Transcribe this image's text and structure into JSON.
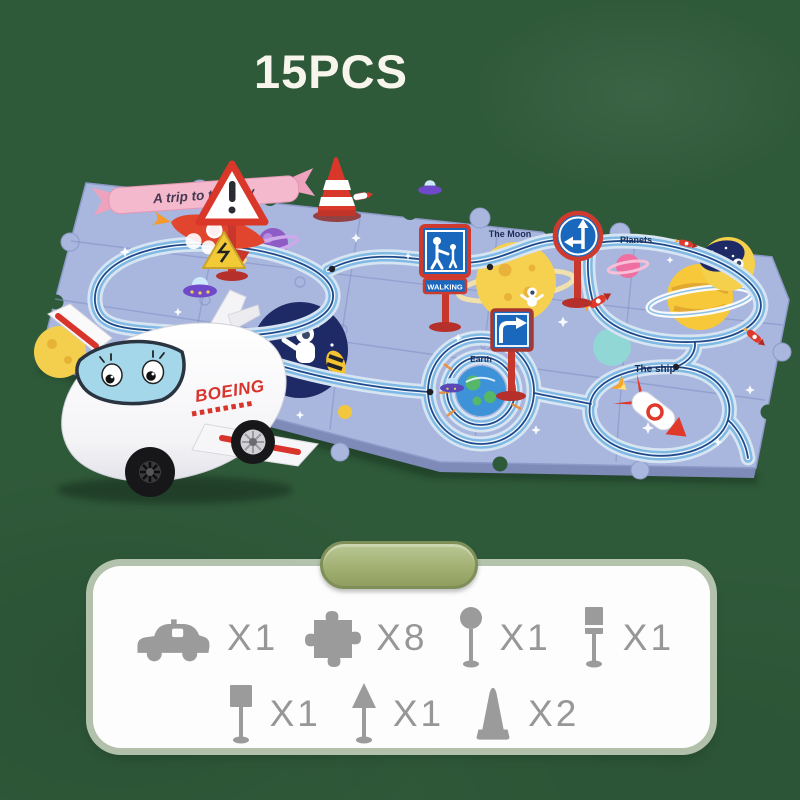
{
  "page": {
    "count_badge": "15PCS",
    "background_color": "#2f5a3a"
  },
  "mat": {
    "banner_label": "A trip to the sky",
    "moon_label": "The Moon",
    "planets_label": "Planets",
    "earth_label": "Earth",
    "ship_label": "The ship",
    "walking_sign_label": "WALKING",
    "mat_color": "#a9b6de",
    "track_color": "#7fb9e4",
    "sign_pole_color": "#c8372c",
    "sign_face_color": "#1968bd"
  },
  "plane": {
    "brand_label": "BOEING",
    "body_color": "#ffffff",
    "accent_color": "#d9342b",
    "windshield_color": "#a5d7ea"
  },
  "parts_panel": {
    "pill_color": "#a3b173",
    "icon_color": "#9b9b9b",
    "items": [
      {
        "icon": "toy-vehicle-icon",
        "count": "X1"
      },
      {
        "icon": "puzzle-piece-icon",
        "count": "X8"
      },
      {
        "icon": "round-sign-icon",
        "count": "X1"
      },
      {
        "icon": "tall-sign-icon",
        "count": "X1"
      },
      {
        "icon": "square-sign-icon",
        "count": "X1"
      },
      {
        "icon": "arrow-sign-icon",
        "count": "X1"
      },
      {
        "icon": "traffic-cone-icon",
        "count": "X2"
      }
    ]
  }
}
